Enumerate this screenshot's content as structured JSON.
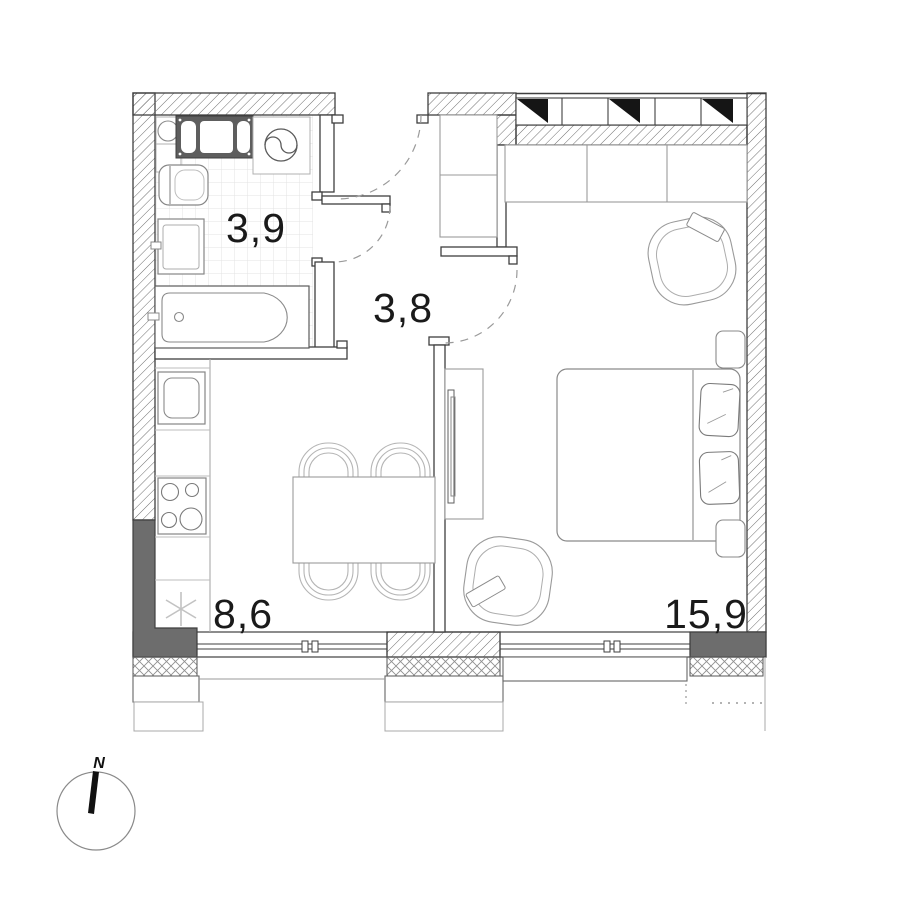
{
  "plan": {
    "type": "apartment-floor-plan",
    "rooms": [
      {
        "name": "bathroom",
        "area_label": "3,9"
      },
      {
        "name": "hallway",
        "area_label": "3,8"
      },
      {
        "name": "kitchen",
        "area_label": "8,6"
      },
      {
        "name": "living-room",
        "area_label": "15,9"
      }
    ],
    "compass": {
      "north_label": "N"
    },
    "colors": {
      "wall_dark_fill": "#6d6d6d",
      "outline": "#3f3f3f",
      "furniture_line": "#9a9a9a",
      "background": "#ffffff"
    }
  }
}
